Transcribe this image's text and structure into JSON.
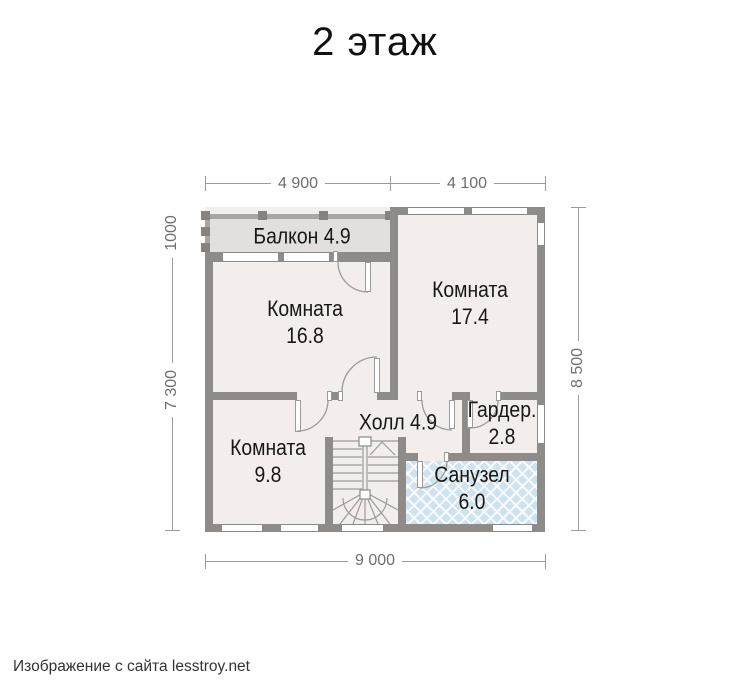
{
  "title": "2 этаж",
  "watermark": "Изображение с сайта lesstroy.net",
  "floor_plan": {
    "rooms": {
      "balcony": {
        "name": "Балкон",
        "area": "4.9"
      },
      "room_16_8": {
        "name": "Комната",
        "area": "16.8"
      },
      "room_17_4": {
        "name": "Комната",
        "area": "17.4"
      },
      "room_9_8": {
        "name": "Комната",
        "area": "9.8"
      },
      "hall": {
        "name": "Холл",
        "area": "4.9"
      },
      "wardrobe": {
        "name": "Гардер.",
        "area": "2.8"
      },
      "bathroom": {
        "name": "Санузел",
        "area": "6.0"
      }
    },
    "dimensions": {
      "top": [
        "4 900",
        "4 100"
      ],
      "left": [
        "1000",
        "7 300"
      ],
      "right": [
        "8 500"
      ],
      "bottom": [
        "9 000"
      ]
    },
    "colors": {
      "wall": "#8e8b88",
      "room_fill": "#f3eeeb",
      "balcony_fill": "#e2dfdc",
      "bathroom_fill": "#cfe2f0"
    }
  }
}
